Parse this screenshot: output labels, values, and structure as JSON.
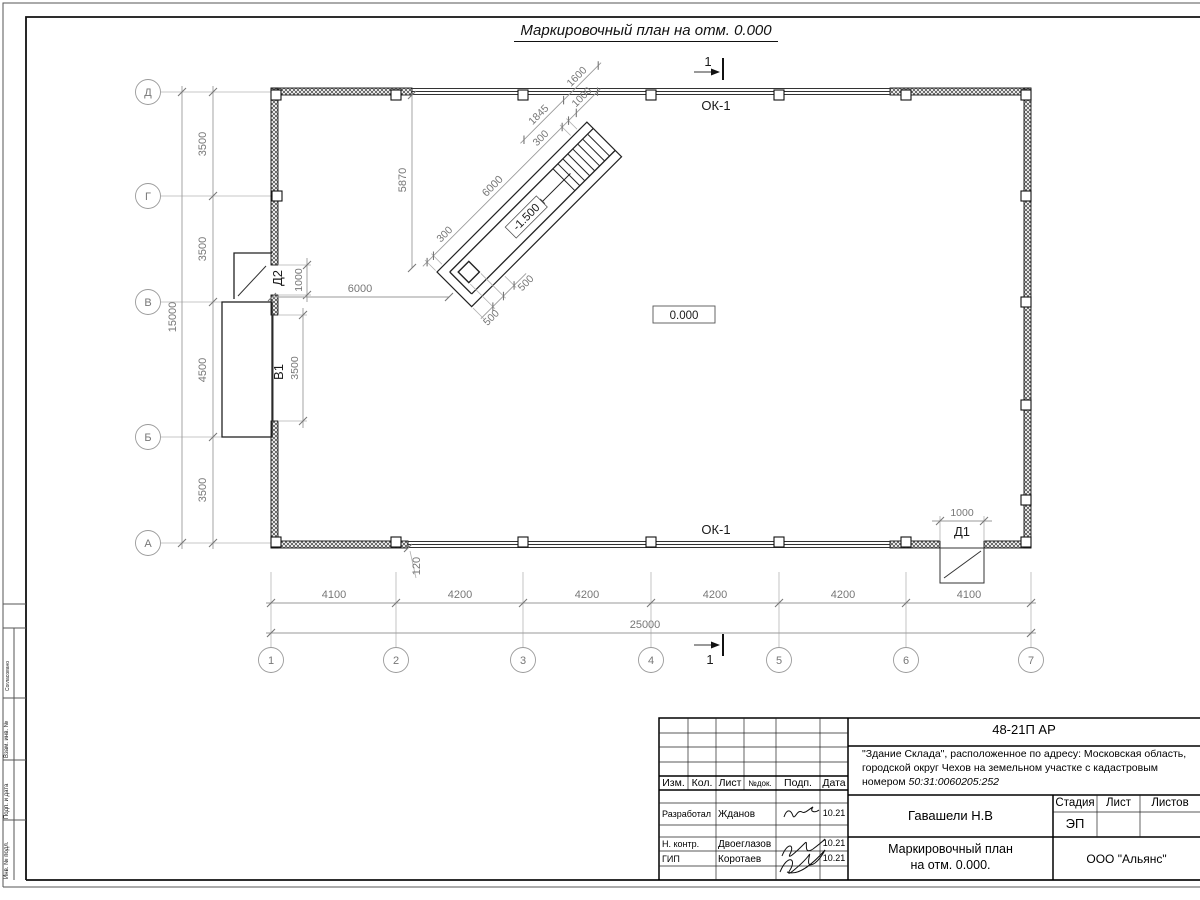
{
  "title": "Маркировочный план на отм. 0.000",
  "plan": {
    "row_labels": [
      "Д",
      "Г",
      "В",
      "Б",
      "А"
    ],
    "col_labels": [
      "1",
      "2",
      "3",
      "4",
      "5",
      "6",
      "7"
    ],
    "left_dims": [
      "3500",
      "3500",
      "4500",
      "3500"
    ],
    "left_total": "15000",
    "bottom_dims": [
      "4100",
      "4200",
      "4200",
      "4200",
      "4200",
      "4100"
    ],
    "bottom_total": "25000",
    "ok1": "ОК-1",
    "level_main": "0.000",
    "level_pit": "-1.500",
    "section": "1",
    "d2": {
      "label": "Д2",
      "dim": "1000"
    },
    "d1": {
      "label": "Д1",
      "dim": "1000"
    },
    "v1": {
      "label": "В1",
      "dim": "3500"
    },
    "dim_6000_left": "6000",
    "dim_5870": "5870",
    "dim_120": "120",
    "ramp": {
      "dim_length": "6000",
      "dim_wall_a": "300",
      "dim_wall_b": "300",
      "dim_stair": "1845",
      "dim_width": "1600",
      "dim_stair_width": "1000",
      "dim_pad_a": "500",
      "dim_pad_b": "500"
    }
  },
  "frame": {
    "side_labels": [
      "Согласовано",
      "Взам. инв. №",
      "Подп. и дата",
      "Инв. № подл."
    ]
  },
  "titleblock": {
    "doc_number": "48-21П АР",
    "desc_line1": "\"Здание Склада\", расположенное по адресу: Московская область,",
    "desc_line2": "городской округ Чехов на земельном участке с кадастровым",
    "desc_line3_prefix": "номером ",
    "cadastral": "50:31:0060205:252",
    "header_cells": [
      "Изм.",
      "Кол.",
      "Лист",
      "№док.",
      "Подп.",
      "Дата"
    ],
    "rows": [
      {
        "role": "Разработал",
        "name": "Жданов",
        "date": "10.21"
      },
      {
        "role": "Н. контр.",
        "name": "Двоеглазов",
        "date": "10.21"
      },
      {
        "role": "ГИП",
        "name": "Коротаев",
        "date": "10.21"
      }
    ],
    "chief": "Гавашели Н.В",
    "stage_label": "Стадия",
    "sheet_label": "Лист",
    "sheets_label": "Листов",
    "stage_value": "ЭП",
    "doc_title_line1": "Маркировочный план",
    "doc_title_line2": "на отм. 0.000.",
    "company": "ООО \"Альянс\""
  }
}
